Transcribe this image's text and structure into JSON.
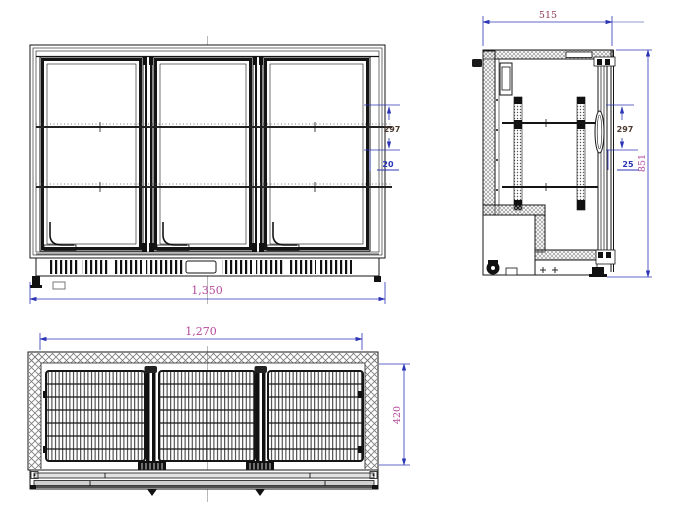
{
  "views": {
    "front": {
      "dims": {
        "overall_width": "1,350",
        "shelf_spacing": "297",
        "shelf_gap": "20"
      }
    },
    "side": {
      "dims": {
        "overall_depth": "515",
        "overall_height": "851",
        "shelf_spacing": "297",
        "shelf_gap": "25"
      }
    },
    "top": {
      "dims": {
        "inner_width": "1,270",
        "inner_depth": "420"
      }
    }
  },
  "colors": {
    "dim_blue": "#2b35b5",
    "dim_magenta": "#b5499c",
    "dim_red": "#8e3a52",
    "dim_brown": "#4d3a31",
    "line": "#151515"
  }
}
